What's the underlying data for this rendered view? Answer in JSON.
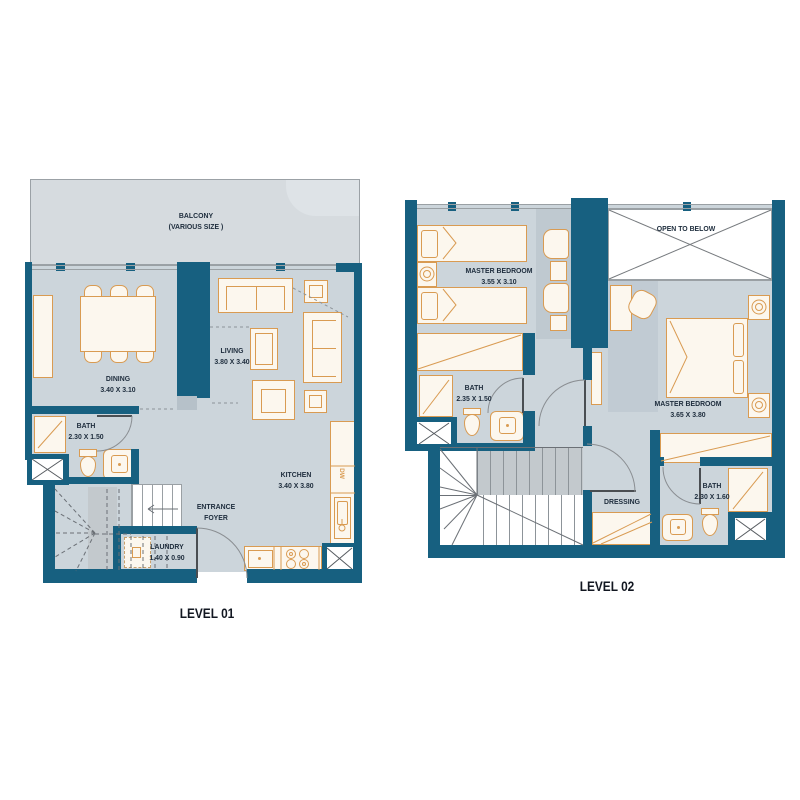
{
  "colors": {
    "wall": "#176080",
    "floor": "#ccd5db",
    "furniture_line": "#d99b52",
    "balcony": "#d6dbdf",
    "label_text": "#1d2c3c"
  },
  "level01": {
    "title": "LEVEL 01",
    "balcony": {
      "name": "BALCONY",
      "note": "(VARIOUS SIZE )"
    },
    "dining": {
      "name": "DINING",
      "dims": "3.40 X 3.10"
    },
    "living": {
      "name": "LIVING",
      "dims": "3.80 X 3.40"
    },
    "bath": {
      "name": "BATH",
      "dims": "2.30 X 1.50"
    },
    "kitchen": {
      "name": "KITCHEN",
      "dims": "3.40 X 3.80"
    },
    "entrance": {
      "line1": "ENTRANCE",
      "line2": "FOYER"
    },
    "laundry": {
      "name": "LAUNDRY",
      "dims": "1.40 X 0.90"
    },
    "dishwasher": "DW"
  },
  "level02": {
    "title": "LEVEL 02",
    "master_bedroom_1": {
      "name": "MASTER BEDROOM",
      "dims": "3.55 X 3.10"
    },
    "master_bedroom_2": {
      "name": "MASTER BEDROOM",
      "dims": "3.65 X 3.80"
    },
    "bath_1": {
      "name": "BATH",
      "dims": "2.35 X 1.50"
    },
    "bath_2": {
      "name": "BATH",
      "dims": "2.30 X 1.60"
    },
    "dressing": {
      "name": "DRESSING"
    },
    "open_to_below": {
      "name": "OPEN TO BELOW"
    }
  }
}
